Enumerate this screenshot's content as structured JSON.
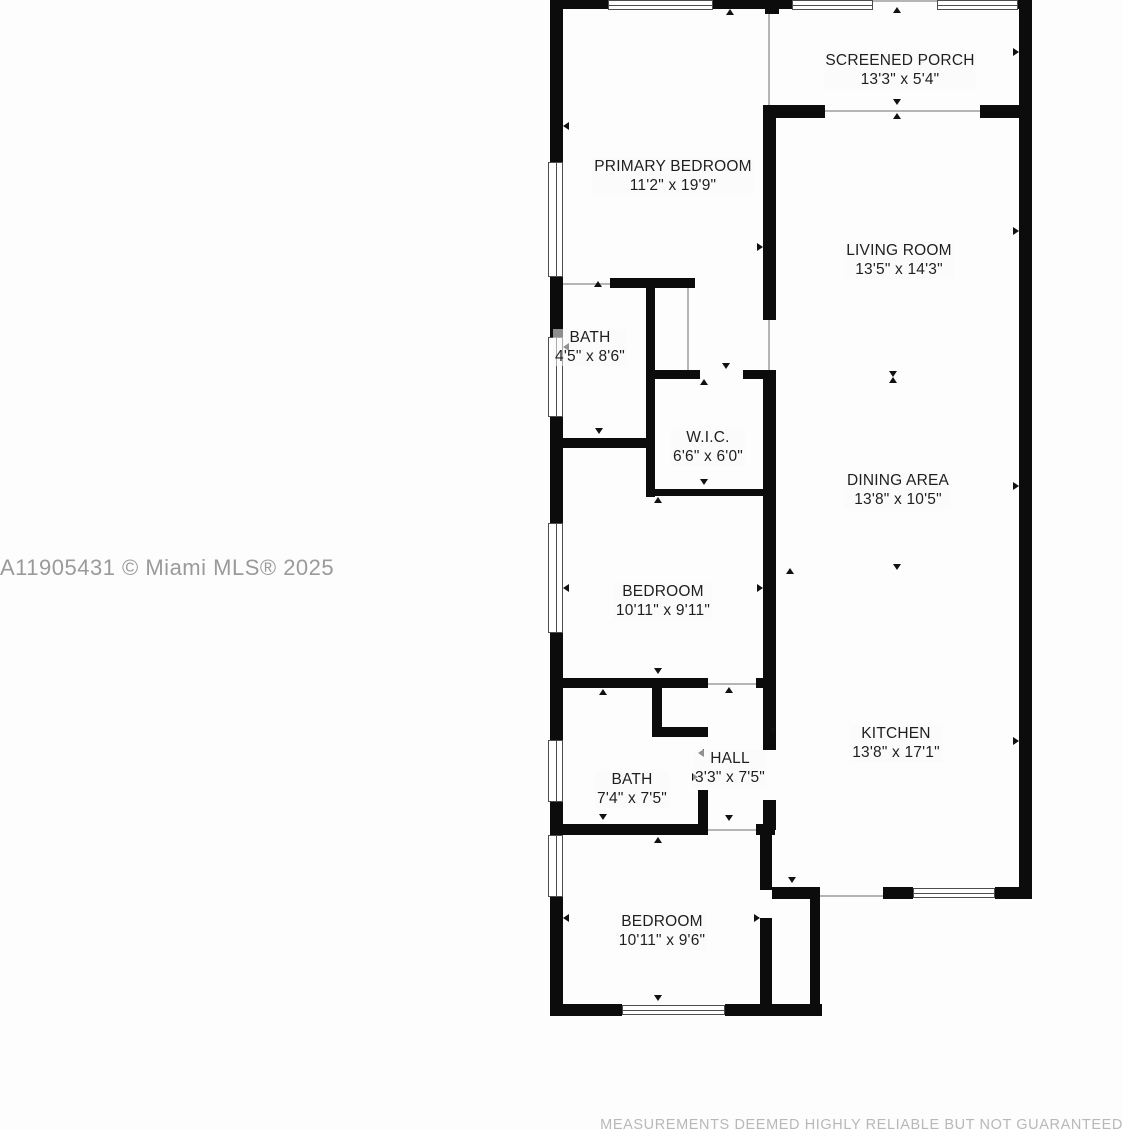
{
  "floorplan": {
    "watermark": "A11905431 © Miami MLS® 2025",
    "disclaimer": "MEASUREMENTS DEEMED HIGHLY RELIABLE BUT NOT GUARANTEED",
    "colors": {
      "wall": "#0c0c0c",
      "background": "#fdfdfd",
      "watermark_text": "#9a9a9a",
      "disclaimer_text": "#b8b8b8"
    },
    "rooms": [
      {
        "name": "SCREENED PORCH",
        "dims": "13'3\" x 5'4\""
      },
      {
        "name": "PRIMARY BEDROOM",
        "dims": "11'2\" x 19'9\""
      },
      {
        "name": "LIVING ROOM",
        "dims": "13'5\" x 14'3\""
      },
      {
        "name": "BATH",
        "dims": "4'5\" x 8'6\""
      },
      {
        "name": "W.I.C.",
        "dims": "6'6\" x 6'0\""
      },
      {
        "name": "DINING AREA",
        "dims": "13'8\" x 10'5\""
      },
      {
        "name": "BEDROOM",
        "dims": "10'11\" x 9'11\""
      },
      {
        "name": "HALL",
        "dims": "3'3\" x 7'5\""
      },
      {
        "name": "BATH",
        "dims": "7'4\" x 7'5\""
      },
      {
        "name": "KITCHEN",
        "dims": "13'8\" x 17'1\""
      },
      {
        "name": "BEDROOM",
        "dims": "10'11\" x 9'6\""
      }
    ]
  }
}
